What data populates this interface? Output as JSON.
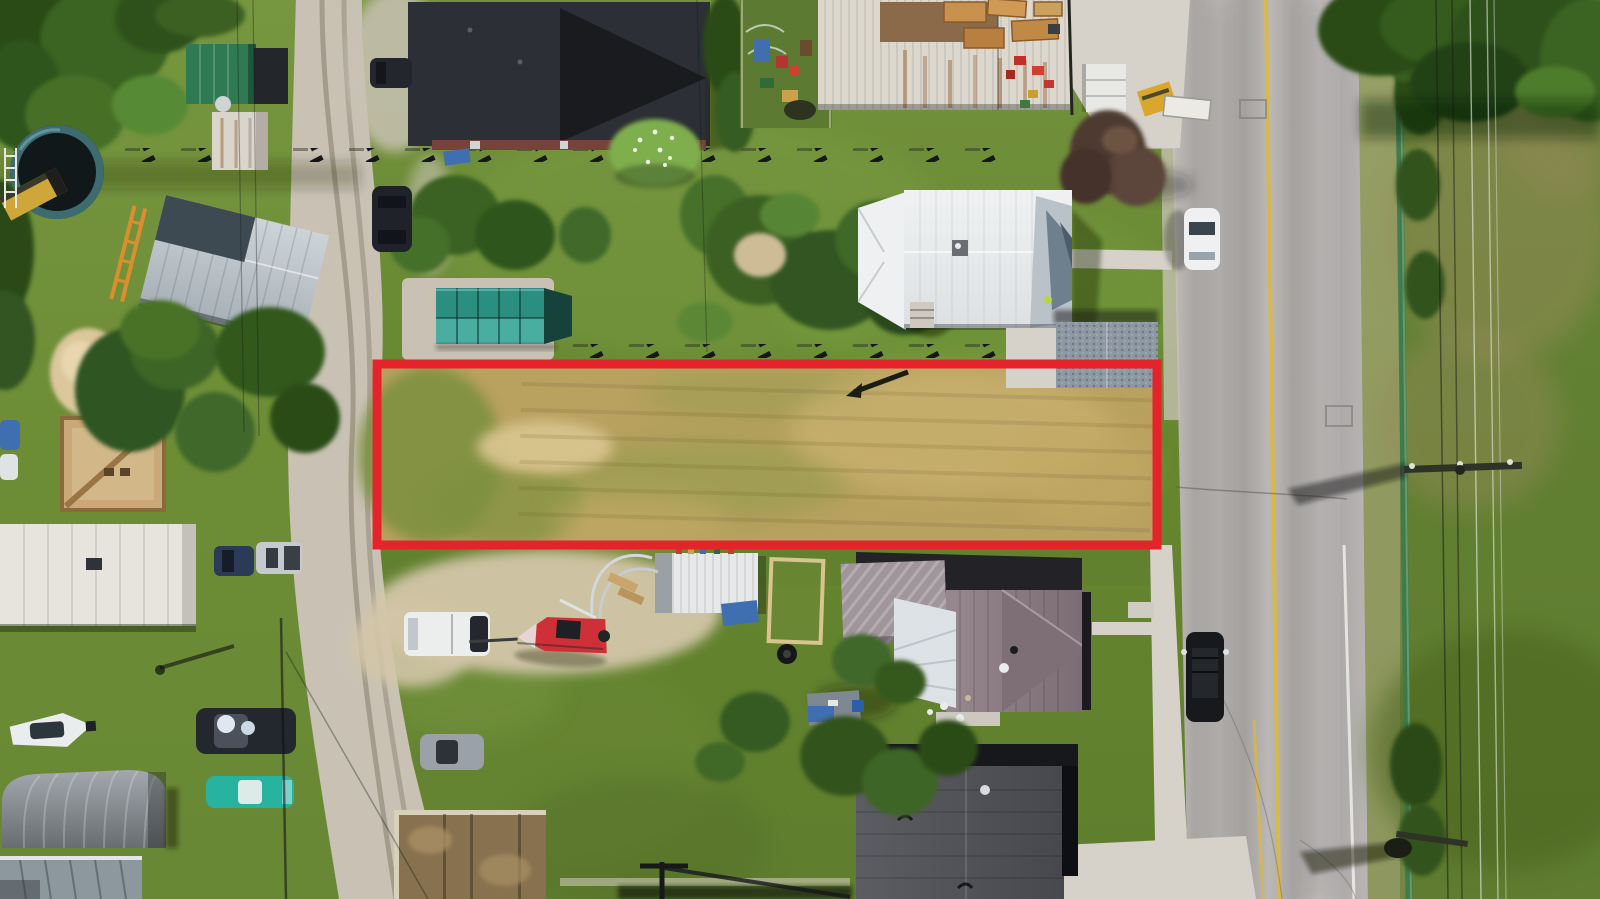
{
  "meta": {
    "type": "aerial-drone-photograph",
    "subject": "Vacant residential building lot highlighted with a red rectangular outline, beside a paved two-lane road",
    "setting": "small-town residential block in summer, overhead view"
  },
  "annotation": {
    "outline_shape": "rectangle",
    "outline_color": "#e3242b",
    "outline_role": "property-boundary-highlight"
  },
  "palette": {
    "grass": "#6d8c3a",
    "grass_light": "#7da046",
    "grass_dark": "#53702b",
    "dry_grass": "#948a58",
    "lot_tan": "#b9a160",
    "lot_sand": "#d8c48e",
    "asphalt": "#b5b2b0",
    "concrete": "#d6d2ca",
    "gravel": "#c9c2b4",
    "dirt": "#d3c6a8",
    "red": "#e3242b",
    "yellow_line": "#d9b84a",
    "roof_dark": "#2c2f35",
    "roof_black": "#17181c",
    "roof_white": "#e9ebec",
    "roof_silver": "#c3cad0",
    "roof_slate": "#3e4a52",
    "roof_mauve": "#8d7d85",
    "roof_gray": "#515257",
    "teal_shed": "#2a8f80",
    "green_roof": "#2f7a52",
    "rust": "#9a6030",
    "tree_green": "#3a6021",
    "tree_dark": "#2b4b16",
    "tree_light": "#5c8836",
    "fence_green": "#3a7a4e",
    "boat_red": "#cf3038",
    "car_teal": "#27b3a0",
    "tarp_blue": "#3f6fb0",
    "lumber": "#c9914e",
    "machine_yellow": "#d9a62e"
  },
  "objects": {
    "photo": {
      "label": "aerial photo of residential block with outlined vacant lot"
    },
    "red_outline": {
      "label": "red property boundary outline around vacant lot"
    },
    "vacant_lot": {
      "label": "vacant lot of dry and green grass"
    },
    "highway": {
      "label": "paved road with yellow centre line"
    },
    "gravel_street": {
      "label": "gravel side street"
    },
    "white_house": {
      "label": "white metal roof house north of lot"
    },
    "garage": {
      "label": "gray shingled garage"
    },
    "dark_roof_building": {
      "label": "large dark roof building"
    },
    "rust_shed": {
      "label": "white shed with rust streaked roof"
    },
    "garden": {
      "label": "garden with colourful equipment"
    },
    "teal_shed": {
      "label": "teal panel shed on gravel pad"
    },
    "silver_house": {
      "label": "silver metal roof house"
    },
    "trampoline": {
      "label": "round trampoline"
    },
    "sand_pile": {
      "label": "sand pile"
    },
    "foundation": {
      "label": "wooden foundation under construction"
    },
    "purple_house": {
      "label": "mauve metal roof house south of lot"
    },
    "dark_shop": {
      "label": "dark gray shop building"
    },
    "white_shed": {
      "label": "small white shed with blue tarp"
    },
    "red_boat": {
      "label": "red boat on trailer"
    },
    "white_boat": {
      "label": "white boat on lawn"
    },
    "quonset": {
      "label": "gray tarp quonset shelter"
    },
    "trailer_home": {
      "label": "long white roof trailer building"
    },
    "white_car": {
      "label": "white car driving on road"
    },
    "suv_parked": {
      "label": "dark SUV parked on gravel street"
    },
    "suv_road": {
      "label": "dark SUV parked along road"
    },
    "pickup": {
      "label": "silver pickup truck"
    },
    "blue_car": {
      "label": "dark blue car"
    },
    "dark_car": {
      "label": "dark car with windshield glare"
    },
    "teal_car": {
      "label": "teal classic car"
    },
    "silver_car": {
      "label": "silver car"
    },
    "white_van": {
      "label": "white van"
    },
    "power_pole": {
      "label": "power pole with crossarm"
    },
    "power_lines": {
      "label": "overhead power lines"
    },
    "fence_line": {
      "label": "green fence line along road"
    },
    "lumber": {
      "label": "stacked lumber"
    },
    "equipment": {
      "label": "red yard equipment"
    },
    "maroon_tree": {
      "label": "dark maroon ornamental tree"
    },
    "flower_bush": {
      "label": "white flowering bush"
    }
  }
}
